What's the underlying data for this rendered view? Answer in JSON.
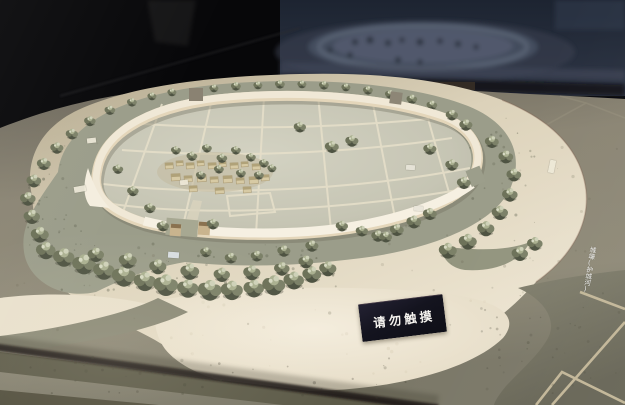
{
  "signs": {
    "do_not_touch": "请勿触摸",
    "moat": "城壕(护城河)"
  },
  "palette": {
    "backdrop_black": "#070709",
    "backdrop_blue": "#2b3342",
    "reflection_grey": "#565e70",
    "outer_terrain": "#868170",
    "embankment_cream": "#e2d8c1",
    "moat_green": "#9b9d8a",
    "city_wall_cream": "#efe6d2",
    "city_ground": "#c9c8b8",
    "field_line": "#e7e0ca",
    "tree_dark": "#4e5342",
    "tree_light": "#aab090",
    "floor_line_tan": "#ccbf9f",
    "case_shadow": "#1c1812",
    "sign_background": "#14141f",
    "sign_text": "#f4f2ee"
  }
}
